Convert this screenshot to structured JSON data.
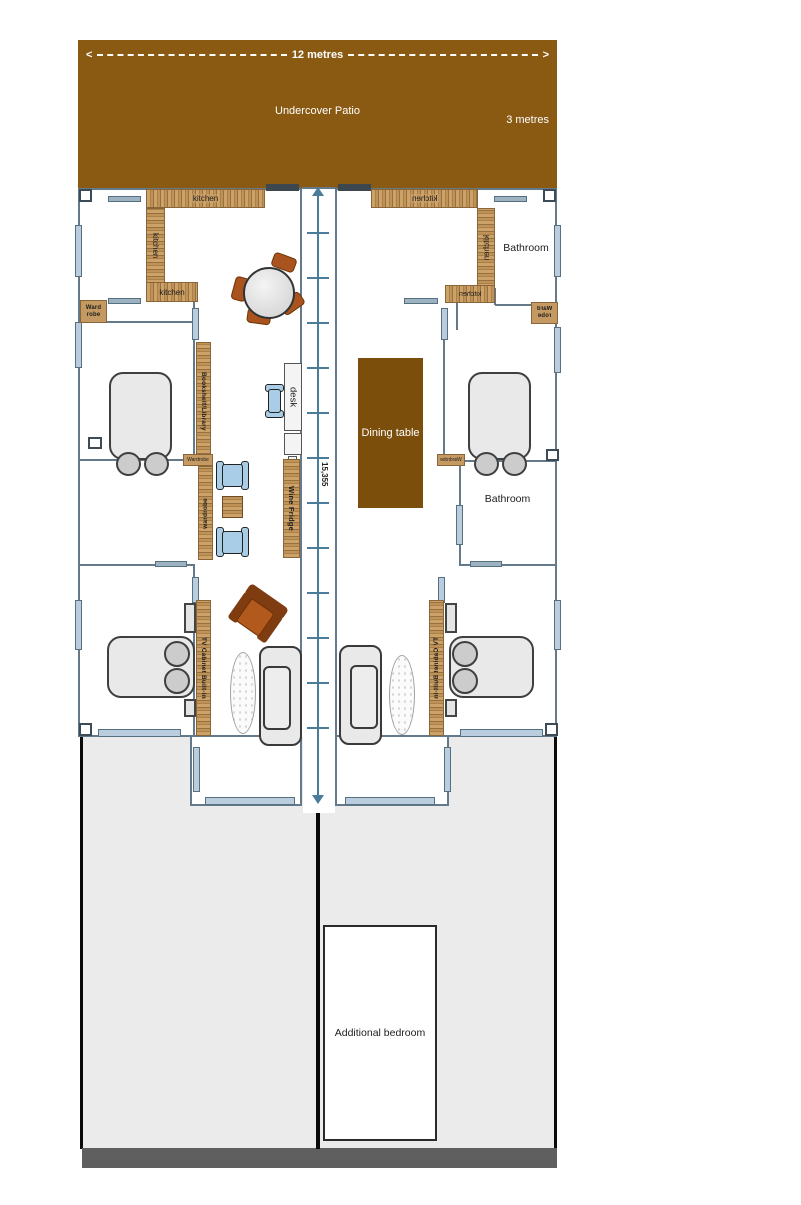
{
  "patio": {
    "label": "Undercover Patio",
    "width_label": "12 metres",
    "depth_label": "3 metres"
  },
  "icons": {
    "arrow_left": "<",
    "arrow_right": ">"
  },
  "center_dimension": {
    "label": "15,355"
  },
  "left_unit": {
    "kitchen_top": "kitchen",
    "kitchen_side": "kitchen",
    "kitchen_bottom": "kitchen",
    "wardrobe_box": "Ward robe",
    "bookshelf": "Bookshelf/Library",
    "wardrobe_tag": "Wardrobe",
    "wardrobe_strip": "wardrobe",
    "desk": "desk",
    "wine_fridge": "Wine Fridge",
    "tv_cabinet": "TV Cabinet Built-in"
  },
  "right_unit": {
    "kitchen_top": "kitchen",
    "kitchen_side": "kitchen",
    "kitchen_bottom": "kitchen",
    "wardrobe_box": "Ward robe",
    "bathroom_upper": "Bathroom",
    "bathroom_mid": "Bathroom",
    "dining_table": "Dining table",
    "wardrobe_tag": "Wardrobe",
    "tv_cabinet": "TV Cabinet Built-in"
  },
  "backyard": {
    "additional_bedroom": "Additional bedroom"
  },
  "colors": {
    "patio_brown": "#8a5a13",
    "dining_table_brown": "#7b4e0c",
    "wood_tan": "#c49a62",
    "wall_blue_gray": "#64798a",
    "window_blue": "#b9cdde",
    "dimension_blue": "#4a7d99",
    "furniture_brown": "#a9541f",
    "chair_blue": "#a9cde6",
    "backyard_gray": "#ebebeb",
    "bottom_bar_gray": "#5f5f5f"
  }
}
